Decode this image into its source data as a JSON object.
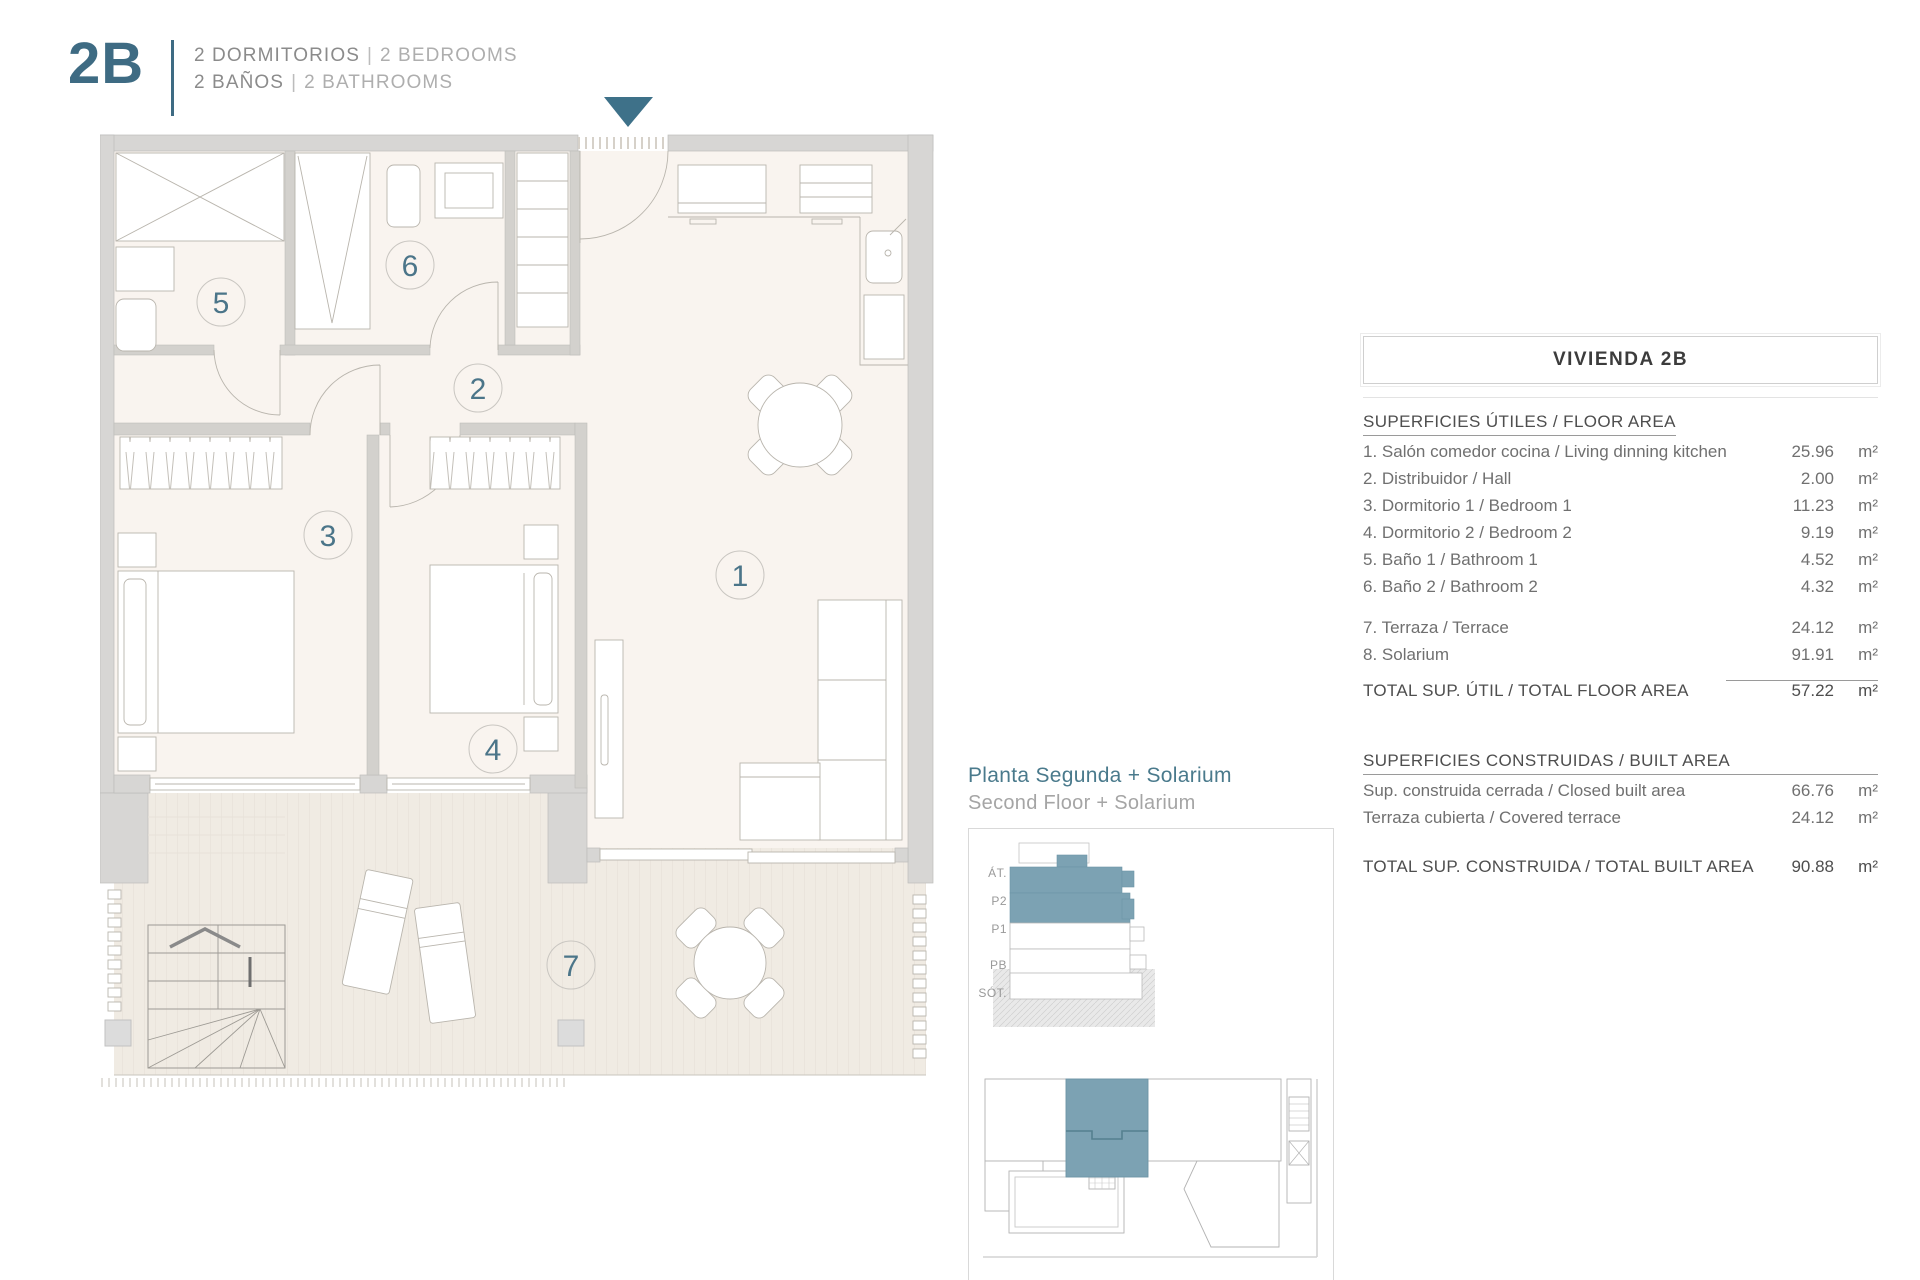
{
  "header": {
    "unit": "2B",
    "line1": {
      "es": "2 DORMITORIOS",
      "en": "2 BEDROOMS"
    },
    "line2": {
      "es": "2 BAÑOS",
      "en": "2 BATHROOMS"
    },
    "sep": "|"
  },
  "plan": {
    "room_numbers": [
      "1",
      "2",
      "3",
      "4",
      "5",
      "6",
      "7"
    ]
  },
  "table": {
    "title": "VIVIENDA 2B",
    "floor_area": {
      "heading": "SUPERFICIES ÚTILES / FLOOR AREA",
      "rows": [
        {
          "label": "1. Salón comedor cocina / Living dinning kitchen",
          "value": "25.96",
          "unit": "m²"
        },
        {
          "label": "2. Distribuidor / Hall",
          "value": "2.00",
          "unit": "m²"
        },
        {
          "label": "3. Dormitorio 1 / Bedroom 1",
          "value": "11.23",
          "unit": "m²"
        },
        {
          "label": "4. Dormitorio 2 / Bedroom 2",
          "value": "9.19",
          "unit": "m²"
        },
        {
          "label": "5. Baño 1 / Bathroom 1",
          "value": "4.52",
          "unit": "m²"
        },
        {
          "label": "6. Baño 2 / Bathroom 2",
          "value": "4.32",
          "unit": "m²"
        }
      ],
      "extra_rows": [
        {
          "label": "7. Terraza / Terrace",
          "value": "24.12",
          "unit": "m²"
        },
        {
          "label": "8. Solarium",
          "value": "91.91",
          "unit": "m²"
        }
      ],
      "total": {
        "label": "TOTAL SUP. ÚTIL / TOTAL FLOOR AREA",
        "value": "57.22",
        "unit": "m²"
      }
    },
    "built_area": {
      "heading": "SUPERFICIES CONSTRUIDAS / BUILT AREA",
      "rows": [
        {
          "label": "Sup. construida cerrada / Closed built area",
          "value": "66.76",
          "unit": "m²"
        },
        {
          "label": "Terraza cubierta / Covered terrace",
          "value": "24.12",
          "unit": "m²"
        }
      ],
      "total": {
        "label": "TOTAL SUP. CONSTRUIDA /  TOTAL BUILT AREA",
        "value": "90.88",
        "unit": "m²"
      }
    }
  },
  "caption": {
    "title": "Planta Segunda + Solarium",
    "subtitle": "Second Floor + Solarium"
  },
  "section_diagram": {
    "levels": [
      "ÁT.",
      "P2",
      "P1",
      "PB",
      "SÓT."
    ]
  },
  "colors": {
    "accent": "#3E7189",
    "highlight": "#7CA2B3"
  }
}
